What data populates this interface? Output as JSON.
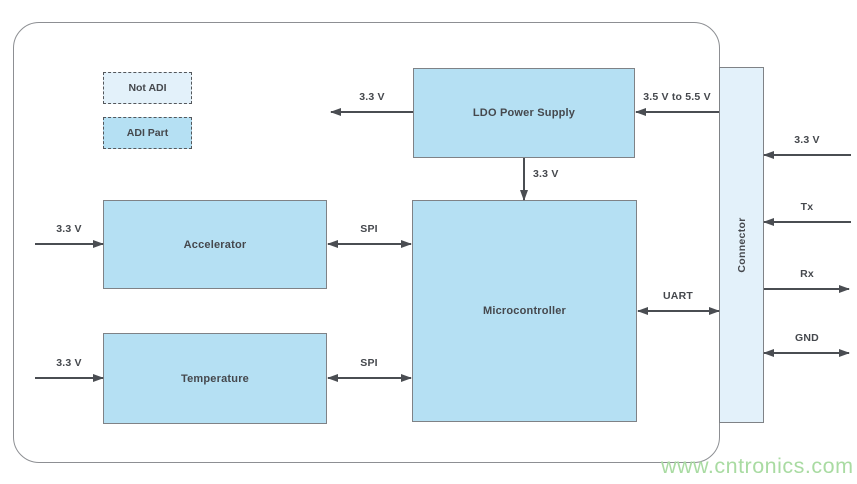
{
  "colors": {
    "block_fill": "#b5e0f3",
    "light_fill": "#e3f1fa",
    "block_border": "#7f8286",
    "board_outline": "#8d8f93",
    "arrow": "#4a4d52",
    "text": "#45484d",
    "watermark_green": "#a9dba2"
  },
  "legend": {
    "not_adi_label": "Not ADI",
    "adi_part_label": "ADI Part"
  },
  "blocks": {
    "ldo_label": "LDO Power Supply",
    "accelerator_label": "Accelerator",
    "temperature_label": "Temperature",
    "microcontroller_label": "Microcontroller",
    "connector_label": "Connector"
  },
  "arrow_labels": {
    "ldo_out": "3.3 V",
    "ldo_in": "3.5 V to 5.5 V",
    "ldo_to_micro": "3.3 V",
    "accelerator_supply": "3.3 V",
    "accelerator_bus": "SPI",
    "temperature_supply": "3.3 V",
    "temperature_bus": "SPI",
    "uart": "UART",
    "connector_supply": "3.3 V",
    "tx": "Tx",
    "rx": "Rx",
    "gnd": "GND"
  },
  "watermark": "www.cntronics.com"
}
